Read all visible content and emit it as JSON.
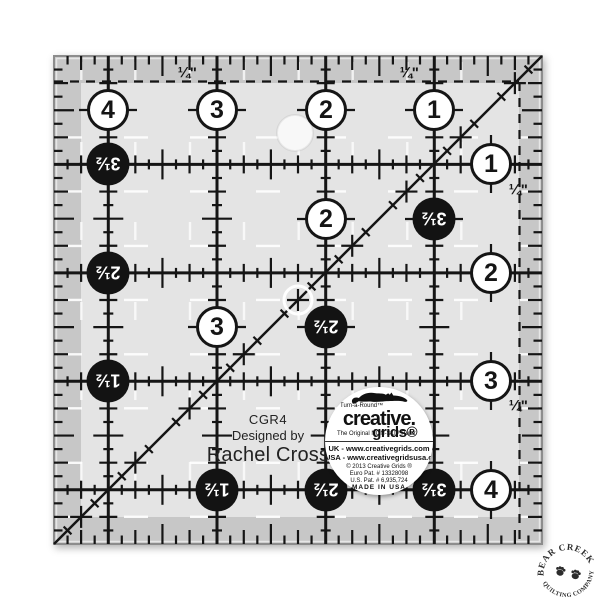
{
  "ruler": {
    "model_label": "CGR4",
    "designed_by_label": "Designed by",
    "designer_name": "Rachel Cross",
    "quarter_inch_label": "¼\"",
    "bubbles": [
      {
        "kind": "white",
        "label": "4",
        "x": 108,
        "y": 110
      },
      {
        "kind": "white",
        "label": "3",
        "x": 217,
        "y": 110
      },
      {
        "kind": "white",
        "label": "2",
        "x": 326,
        "y": 110
      },
      {
        "kind": "white",
        "label": "1",
        "x": 434,
        "y": 110
      },
      {
        "kind": "white",
        "label": "1",
        "x": 491,
        "y": 164
      },
      {
        "kind": "white",
        "label": "2",
        "x": 491,
        "y": 273
      },
      {
        "kind": "white",
        "label": "3",
        "x": 491,
        "y": 381
      },
      {
        "kind": "white",
        "label": "4",
        "x": 491,
        "y": 490
      },
      {
        "kind": "white",
        "label": "2",
        "x": 326,
        "y": 219
      },
      {
        "kind": "white",
        "label": "3",
        "x": 217,
        "y": 327
      },
      {
        "kind": "black",
        "label": "3½",
        "x": 108,
        "y": 164
      },
      {
        "kind": "black",
        "label": "2½",
        "x": 108,
        "y": 273
      },
      {
        "kind": "black",
        "label": "1½",
        "x": 108,
        "y": 381
      },
      {
        "kind": "black",
        "label": "1½",
        "x": 217,
        "y": 490
      },
      {
        "kind": "black",
        "label": "2½",
        "x": 326,
        "y": 490
      },
      {
        "kind": "black",
        "label": "3½",
        "x": 434,
        "y": 490
      },
      {
        "kind": "black",
        "label": "3½",
        "x": 434,
        "y": 219
      },
      {
        "kind": "black",
        "label": "2½",
        "x": 326,
        "y": 327
      }
    ],
    "quarter_labels": [
      {
        "x": 187,
        "y": 73
      },
      {
        "x": 409,
        "y": 73
      },
      {
        "x": 518,
        "y": 190
      },
      {
        "x": 518,
        "y": 406
      }
    ]
  },
  "logo": {
    "turn_a_round": "Turn-a-Round™",
    "brand_top": "creative.",
    "brand_bottom": "grids®",
    "tagline": "The Original NON-SLIP Ruler",
    "uk_line": "UK - www.creativegrids.com",
    "usa_line": "USA - www.creativegridsusa.com",
    "copyright_line": "© 2013 Creative Grids ®",
    "euro_patent": "Euro Pat. # 13328098",
    "us_patent": "U.S. Pat. # 6,935,724",
    "made_in": "MADE IN USA"
  },
  "stamp": {
    "arc_top": "BEAR CREEK",
    "arc_bottom": "QUILTING COMPANY"
  },
  "colors": {
    "band": "#c7c7c7",
    "inner": "#e4e4e4",
    "ink": "#151515",
    "white_mark": "#ffffff"
  }
}
